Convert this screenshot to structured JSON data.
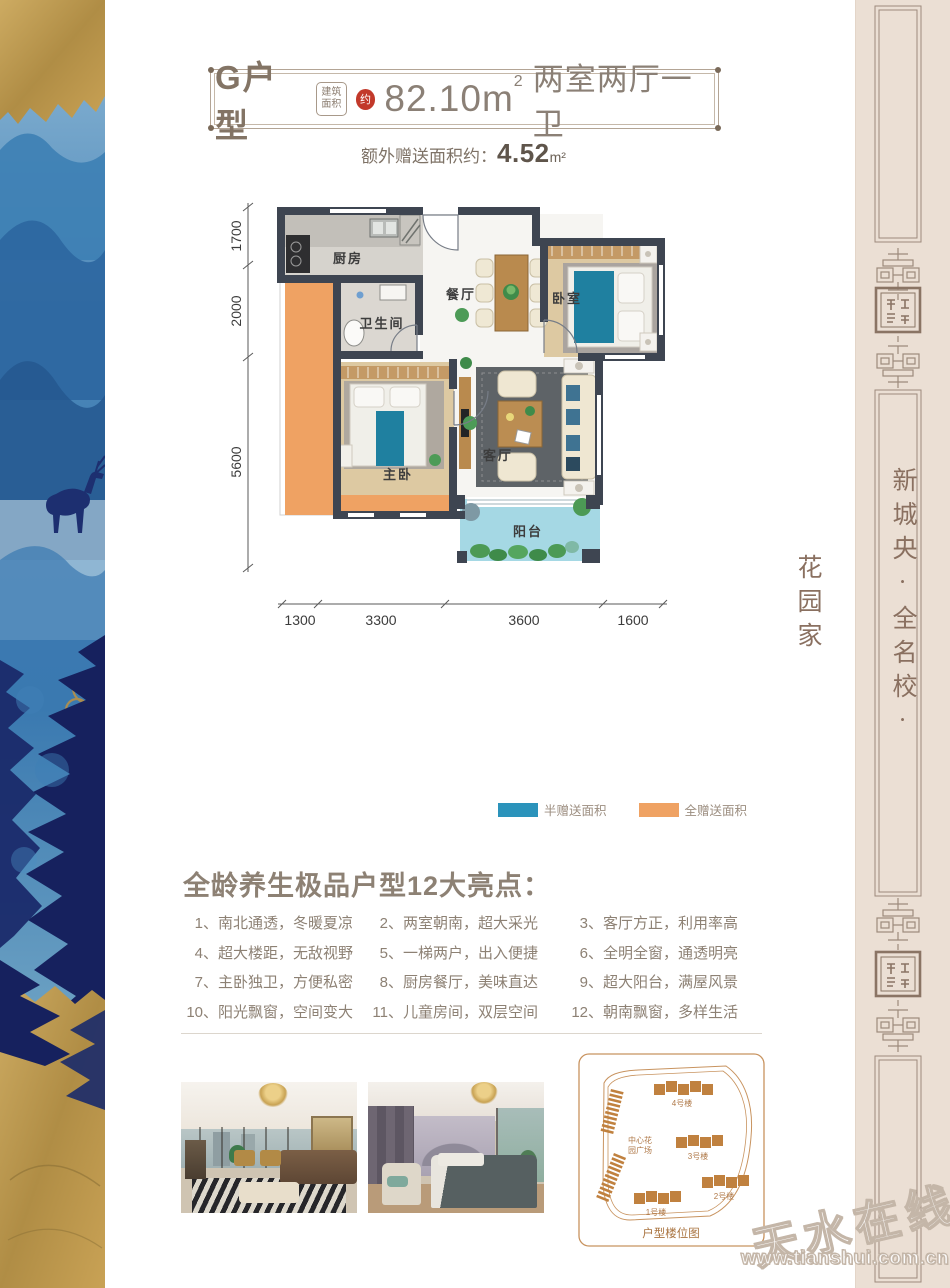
{
  "header": {
    "unit_name": "G户型",
    "badge_top": "建筑",
    "badge_bottom": "面积",
    "approx_mark": "约",
    "area_number": "82.10m",
    "area_sup": "2",
    "layout_desc": "两室两厅一卫",
    "bonus_label": "额外赠送面积约：",
    "bonus_value": "4.52",
    "bonus_unit": "m²"
  },
  "floorplan": {
    "rooms": {
      "kitchen": "厨房",
      "bathroom": "卫生间",
      "dining": "餐厅",
      "bedroom": "卧室",
      "master_bedroom": "主卧",
      "living": "客厅",
      "balcony": "阳台"
    },
    "dims_left": [
      "1700",
      "2000",
      "5600"
    ],
    "dims_bottom": [
      "1300",
      "3300",
      "3600",
      "1600"
    ],
    "colors": {
      "wall": "#3e4551",
      "half_gift": "#2b93bb",
      "full_gift": "#efa263",
      "balcony": "#a5d8e4"
    }
  },
  "legend": {
    "half_gift": "半赠送面积",
    "full_gift": "全赠送面积",
    "half_color": "#2b93bb",
    "full_color": "#efa263"
  },
  "highlights": {
    "title": "全龄养生极品户型12大亮点：",
    "items": [
      {
        "n": "1、",
        "t": "南北通透，冬暖夏凉"
      },
      {
        "n": "2、",
        "t": "两室朝南，超大采光"
      },
      {
        "n": "3、",
        "t": "客厅方正，利用率高"
      },
      {
        "n": "4、",
        "t": "超大楼距，无敌视野"
      },
      {
        "n": "5、",
        "t": "一梯两户，出入便捷"
      },
      {
        "n": "6、",
        "t": "全明全窗，通透明亮"
      },
      {
        "n": "7、",
        "t": "主卧独卫，方便私密"
      },
      {
        "n": "8、",
        "t": "厨房餐厅，美味直达"
      },
      {
        "n": "9、",
        "t": "超大阳台，满屋风景"
      },
      {
        "n": "10、",
        "t": "阳光飘窗，空间变大"
      },
      {
        "n": "11、",
        "t": "儿童房间，双层空间"
      },
      {
        "n": "12、",
        "t": "朝南飘窗，多样生活"
      }
    ]
  },
  "siteplan": {
    "building_4": "4号楼",
    "building_3": "3号楼",
    "building_2": "2号楼",
    "building_1": "1号楼",
    "center_line1": "中心花",
    "center_line2": "园广场",
    "caption": "户型楼位图"
  },
  "sidebar": {
    "slogan": "新城央·全名校·花园家"
  },
  "watermark": {
    "name": "天水在线",
    "url": "www.tianshui.com.cn"
  }
}
